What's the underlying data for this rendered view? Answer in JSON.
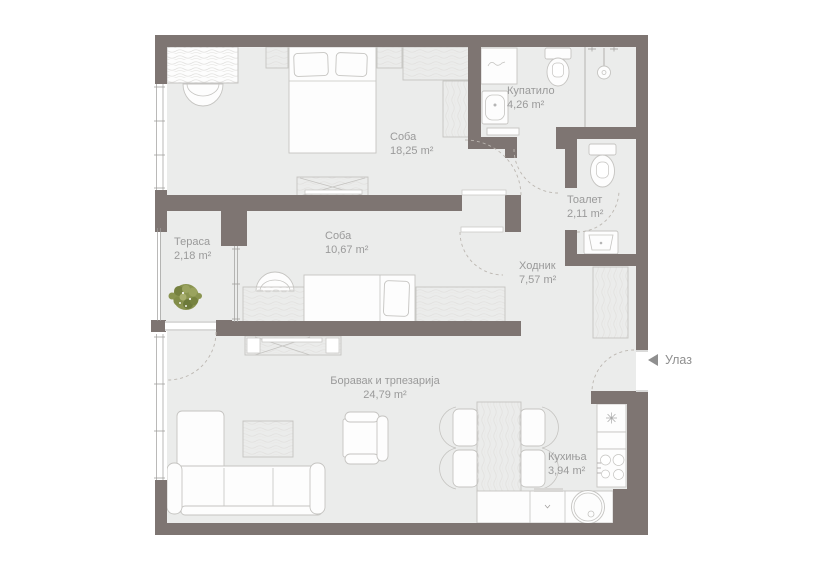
{
  "floorplan": {
    "rooms": [
      {
        "id": "soba-1",
        "label": "Соба",
        "area": "18,25 m²"
      },
      {
        "id": "kupatilo",
        "label": "Купатило",
        "area": "4,26 m²"
      },
      {
        "id": "toalet",
        "label": "Тоалет",
        "area": "2,11 m²"
      },
      {
        "id": "terasa",
        "label": "Тераса",
        "area": "2,18 m²"
      },
      {
        "id": "soba-2",
        "label": "Соба",
        "area": "10,67 m²"
      },
      {
        "id": "hodnik",
        "label": "Ходник",
        "area": "7,57 m²"
      },
      {
        "id": "boravak",
        "label": "Боравак и трпезарија",
        "area": "24,79 m²"
      },
      {
        "id": "kuhinja",
        "label": "Кухиња",
        "area": "3,94 m²"
      }
    ],
    "entrance_label": "Улаз",
    "colors": {
      "wall": "#7e7572",
      "floor": "#ebeceb",
      "furniture_outline": "#c5c4c1",
      "label_text": "#9a9a9a",
      "plant_green": "#8a9450",
      "door_swing_dash": "#bcb7b1",
      "background": "#ffffff"
    }
  }
}
